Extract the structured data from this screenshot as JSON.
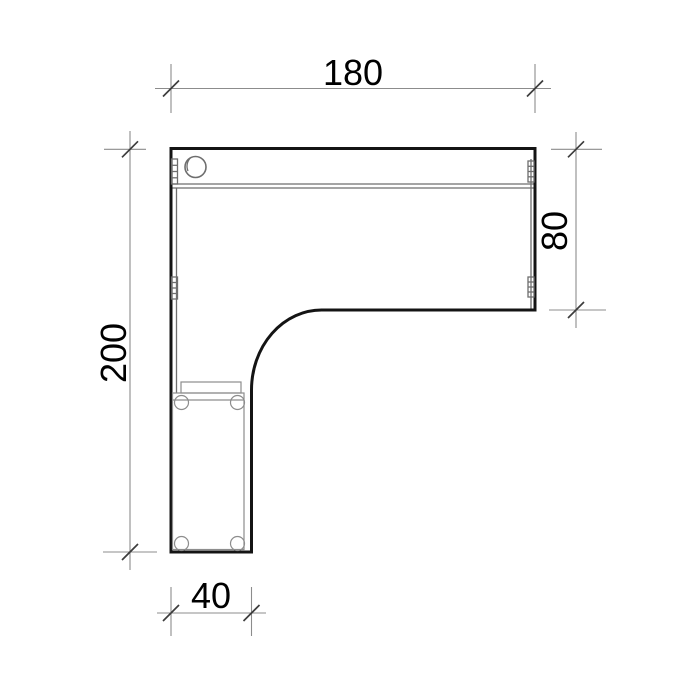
{
  "drawing": {
    "kind": "furniture-plan-top-view",
    "dimensions": {
      "top": {
        "value": "180"
      },
      "right": {
        "value": "80"
      },
      "left": {
        "value": "200"
      },
      "bottom": {
        "value": "40"
      }
    },
    "colors": {
      "background": "#ffffff",
      "outline": "#141414",
      "detail_line": "#6e6e6e",
      "pedestal_line": "#8d8d8d",
      "dimension_line": "#8c8c8c",
      "tick": "#3c3c3c",
      "text": "#000000"
    }
  }
}
